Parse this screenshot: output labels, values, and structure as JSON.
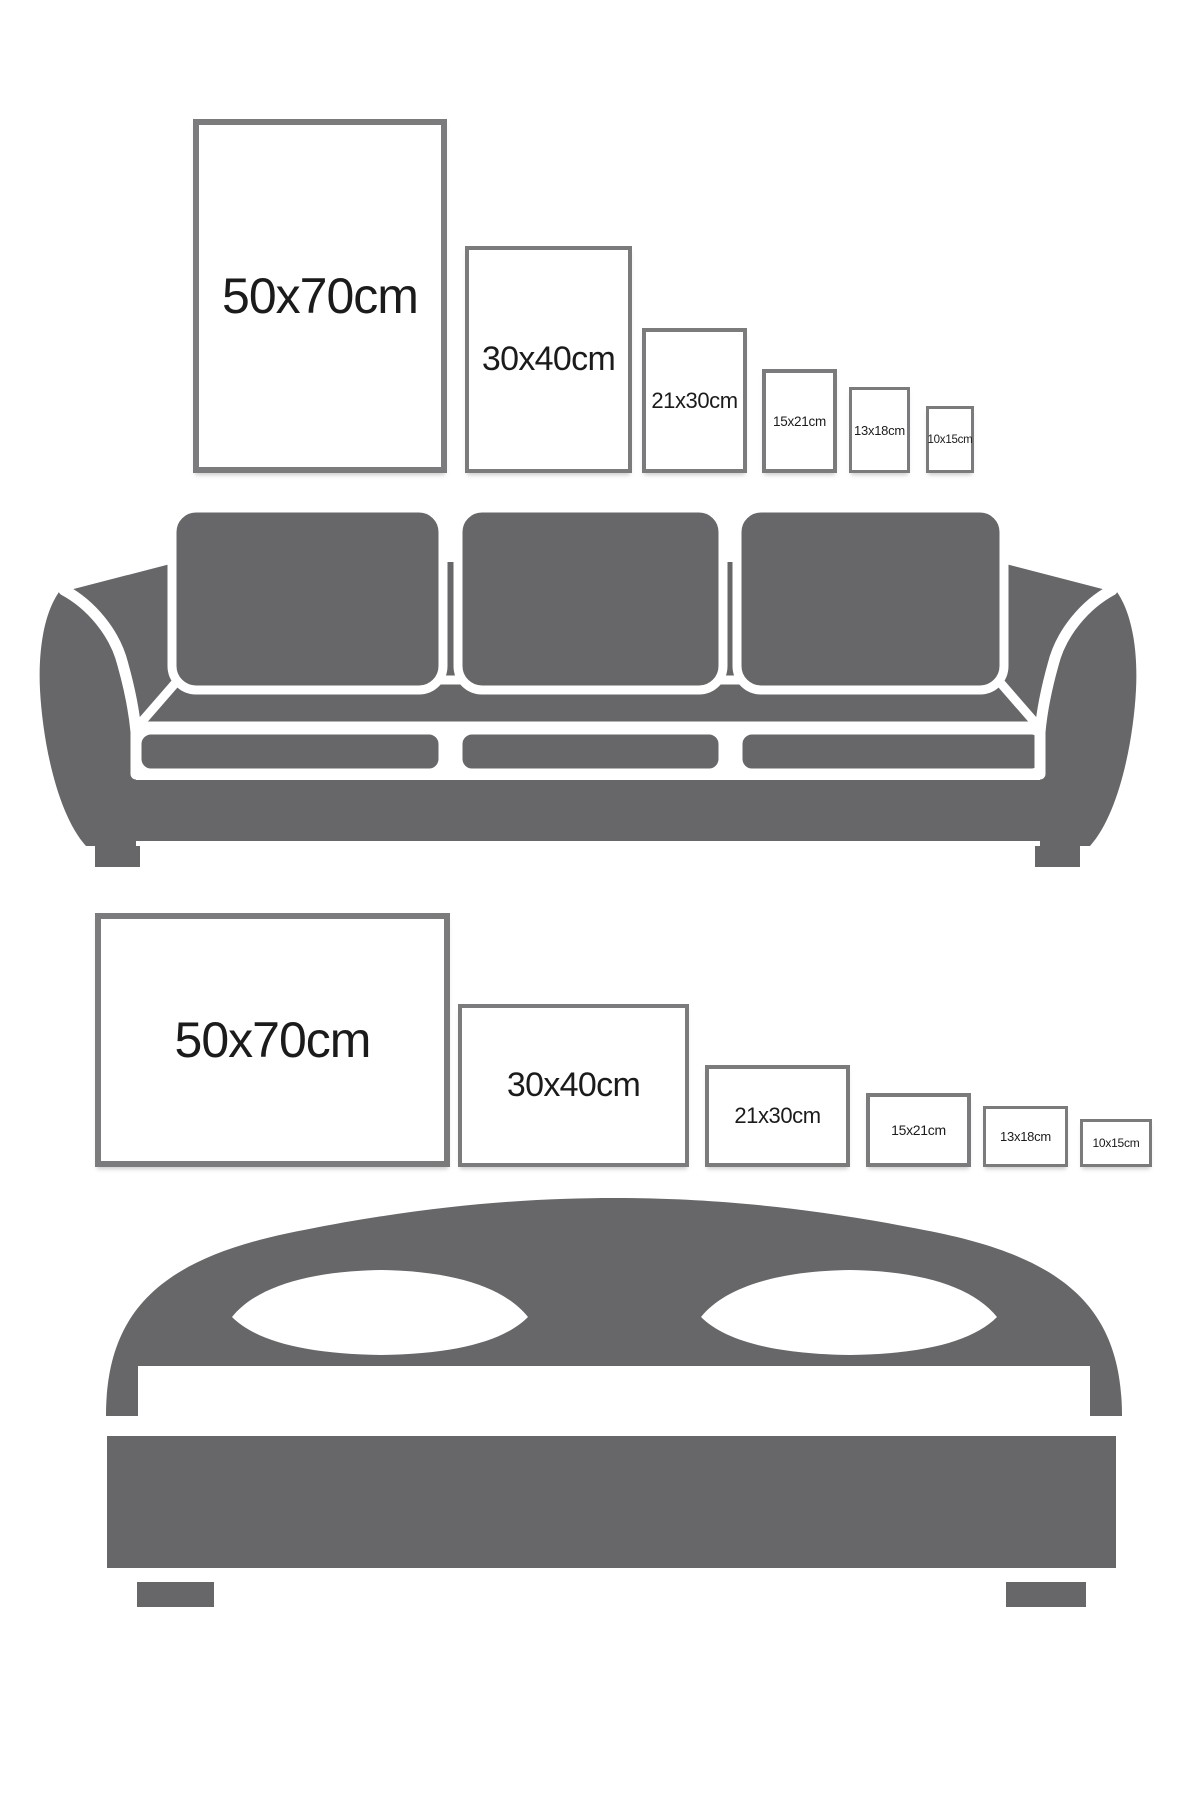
{
  "colors": {
    "background": "#ffffff",
    "furniture_gray": "#67676a",
    "frame_border": "#7b7b7e",
    "frame_fill": "#ffffff",
    "label_text": "#1b1b1b"
  },
  "sections": [
    {
      "id": "sofa",
      "furniture": "three-seat-sofa-silhouette",
      "frames": [
        {
          "label": "50x70cm",
          "x": 193,
          "y": 119,
          "w": 254,
          "h": 354,
          "border": 6,
          "font": 50
        },
        {
          "label": "30x40cm",
          "x": 465,
          "y": 246,
          "w": 167,
          "h": 227,
          "border": 4,
          "font": 34
        },
        {
          "label": "21x30cm",
          "x": 642,
          "y": 328,
          "w": 105,
          "h": 145,
          "border": 4,
          "font": 22
        },
        {
          "label": "15x21cm",
          "x": 762,
          "y": 369,
          "w": 75,
          "h": 104,
          "border": 4,
          "font": 13.5
        },
        {
          "label": "13x18cm",
          "x": 849,
          "y": 387,
          "w": 61,
          "h": 86,
          "border": 3,
          "font": 13
        },
        {
          "label": "10x15cm",
          "x": 926,
          "y": 406,
          "w": 48,
          "h": 67,
          "border": 3,
          "font": 11.5
        }
      ]
    },
    {
      "id": "bed",
      "furniture": "double-bed-silhouette",
      "frames": [
        {
          "label": "50x70cm",
          "x": 95,
          "y": 913,
          "w": 355,
          "h": 254,
          "border": 6,
          "font": 50
        },
        {
          "label": "30x40cm",
          "x": 458,
          "y": 1004,
          "w": 231,
          "h": 163,
          "border": 4,
          "font": 34
        },
        {
          "label": "21x30cm",
          "x": 705,
          "y": 1065,
          "w": 145,
          "h": 102,
          "border": 4,
          "font": 22
        },
        {
          "label": "15x21cm",
          "x": 866,
          "y": 1093,
          "w": 105,
          "h": 74,
          "border": 4,
          "font": 14
        },
        {
          "label": "13x18cm",
          "x": 983,
          "y": 1106,
          "w": 85,
          "h": 61,
          "border": 3,
          "font": 13
        },
        {
          "label": "10x15cm",
          "x": 1080,
          "y": 1119,
          "w": 72,
          "h": 48,
          "border": 3,
          "font": 12
        }
      ]
    }
  ]
}
